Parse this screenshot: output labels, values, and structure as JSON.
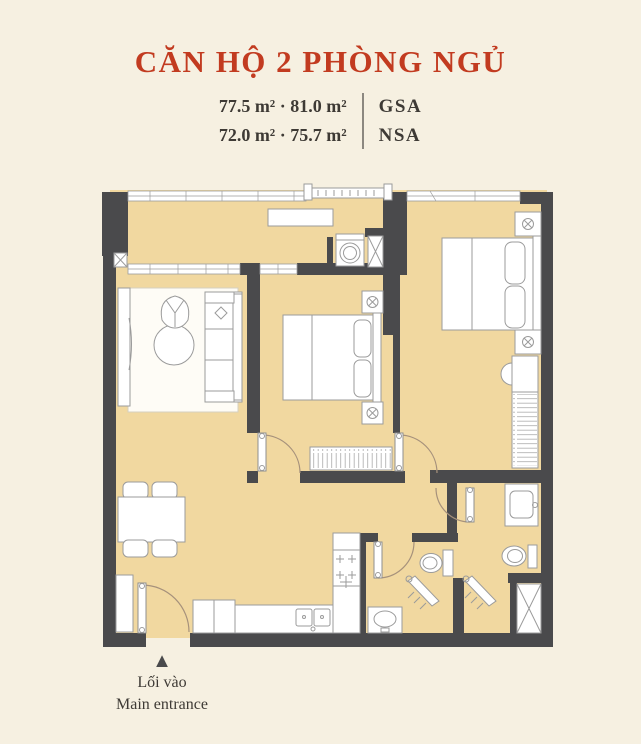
{
  "header": {
    "title": "CĂN HỘ 2 PHÒNG NGỦ",
    "area_line1": "77.5 m² · 81.0 m²",
    "area_line2": "72.0 m² · 75.7 m²",
    "label1": "GSA",
    "label2": "NSA"
  },
  "footer": {
    "marker": "▲",
    "entrance_vi": "Lối vào",
    "entrance_en": "Main entrance"
  },
  "colors": {
    "background": "#f6f0e1",
    "floor": "#f1d8a0",
    "wall": "#4a4a4c",
    "accent": "#c23b20",
    "text": "#3e3a35",
    "line": "#9b9b9b",
    "rug": "#fefcf6",
    "door_arc": "#a6917b",
    "hatch": "#b3b3b3"
  }
}
